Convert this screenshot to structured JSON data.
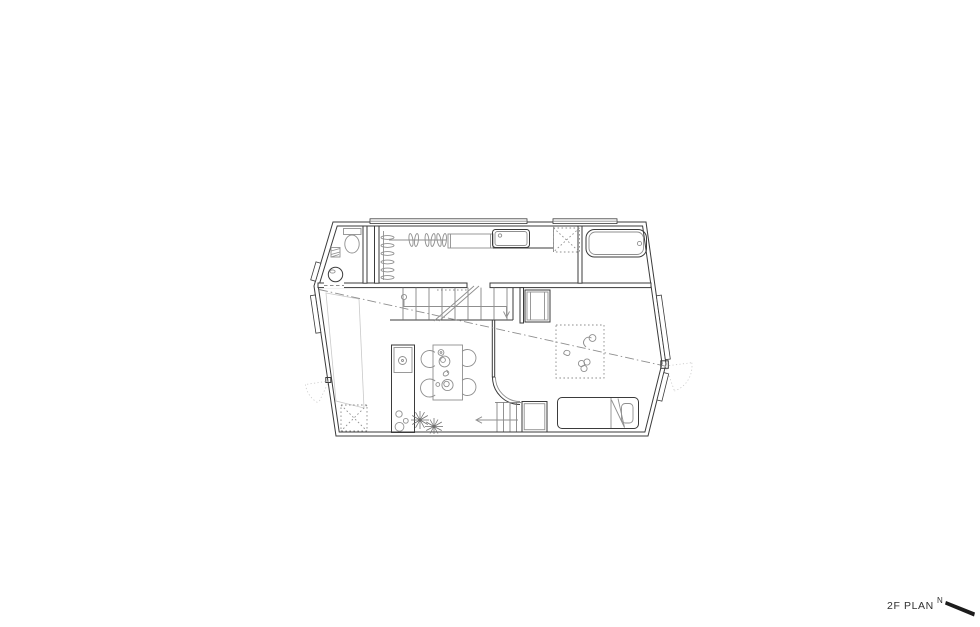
{
  "canvas": {
    "width": 980,
    "height": 627
  },
  "colors": {
    "background": "#ffffff",
    "line_dark": "#3b3b3b",
    "line_mid": "#8f8f8f",
    "line_faint": "#c9c9c9",
    "label": "#2f2f2f"
  },
  "footer": {
    "plan_label": "2F PLAN",
    "north_label": "N"
  },
  "plan": {
    "fixtures": [
      "toilet",
      "hand-wash-basin",
      "clothes-hanger-rack",
      "closet-shelf",
      "washbasin-counter",
      "skylight-hatch-top",
      "skylight-hatch-bottom",
      "bathtub",
      "main-staircase",
      "lower-staircase",
      "bedroom-closet-upper",
      "bedroom-closet-lower",
      "play-rug",
      "toys",
      "single-bed",
      "kitchen-island",
      "island-plants",
      "dining-table",
      "dining-chairs",
      "section-line",
      "window-swing-arcs",
      "north-arrow"
    ]
  }
}
